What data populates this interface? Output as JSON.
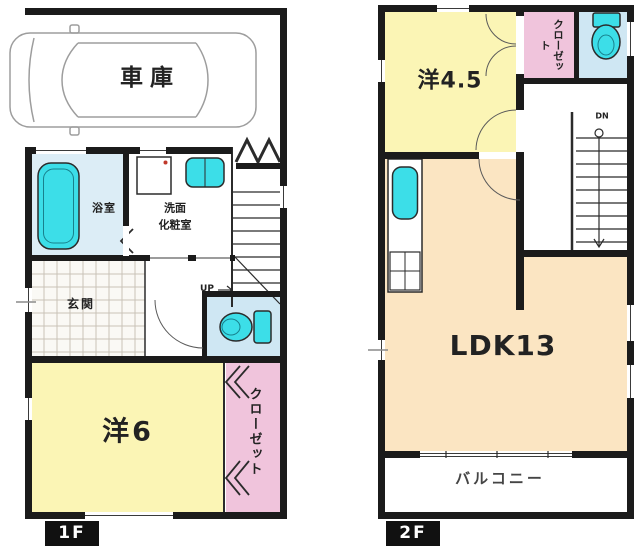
{
  "floor1": {
    "badge": "1F",
    "garage_label": "車庫",
    "bath_label": "浴室",
    "washroom_label_line1": "洗面",
    "washroom_label_line2": "化粧室",
    "entrance_label": "玄関",
    "stairs_label": "UP",
    "bedroom_label": "洋6",
    "closet_label": "クローゼット"
  },
  "floor2": {
    "badge": "2F",
    "bedroom_label": "洋4.5",
    "closet_label": "クローゼット",
    "stairs_label": "DN",
    "ldk_label": "LDK13",
    "balcony_label": "バルコニー"
  },
  "colors": {
    "wall": "#1b1b1b",
    "outline": "#2b2b2b",
    "room_yellow": "#fbf5b5",
    "room_peach": "#fbe5c2",
    "closet_pink": "#f0c4dc",
    "fixture_cyan": "#3cdee8",
    "bath_floor": "#dcedf6",
    "toilet_floor": "#cfe7f3",
    "tile_line": "#c9c3b8",
    "car_line": "#9d9d9d",
    "door_arc": "#5a5a5a",
    "text": "#222222",
    "badge_bg": "#111111",
    "badge_text": "#ffffff"
  }
}
